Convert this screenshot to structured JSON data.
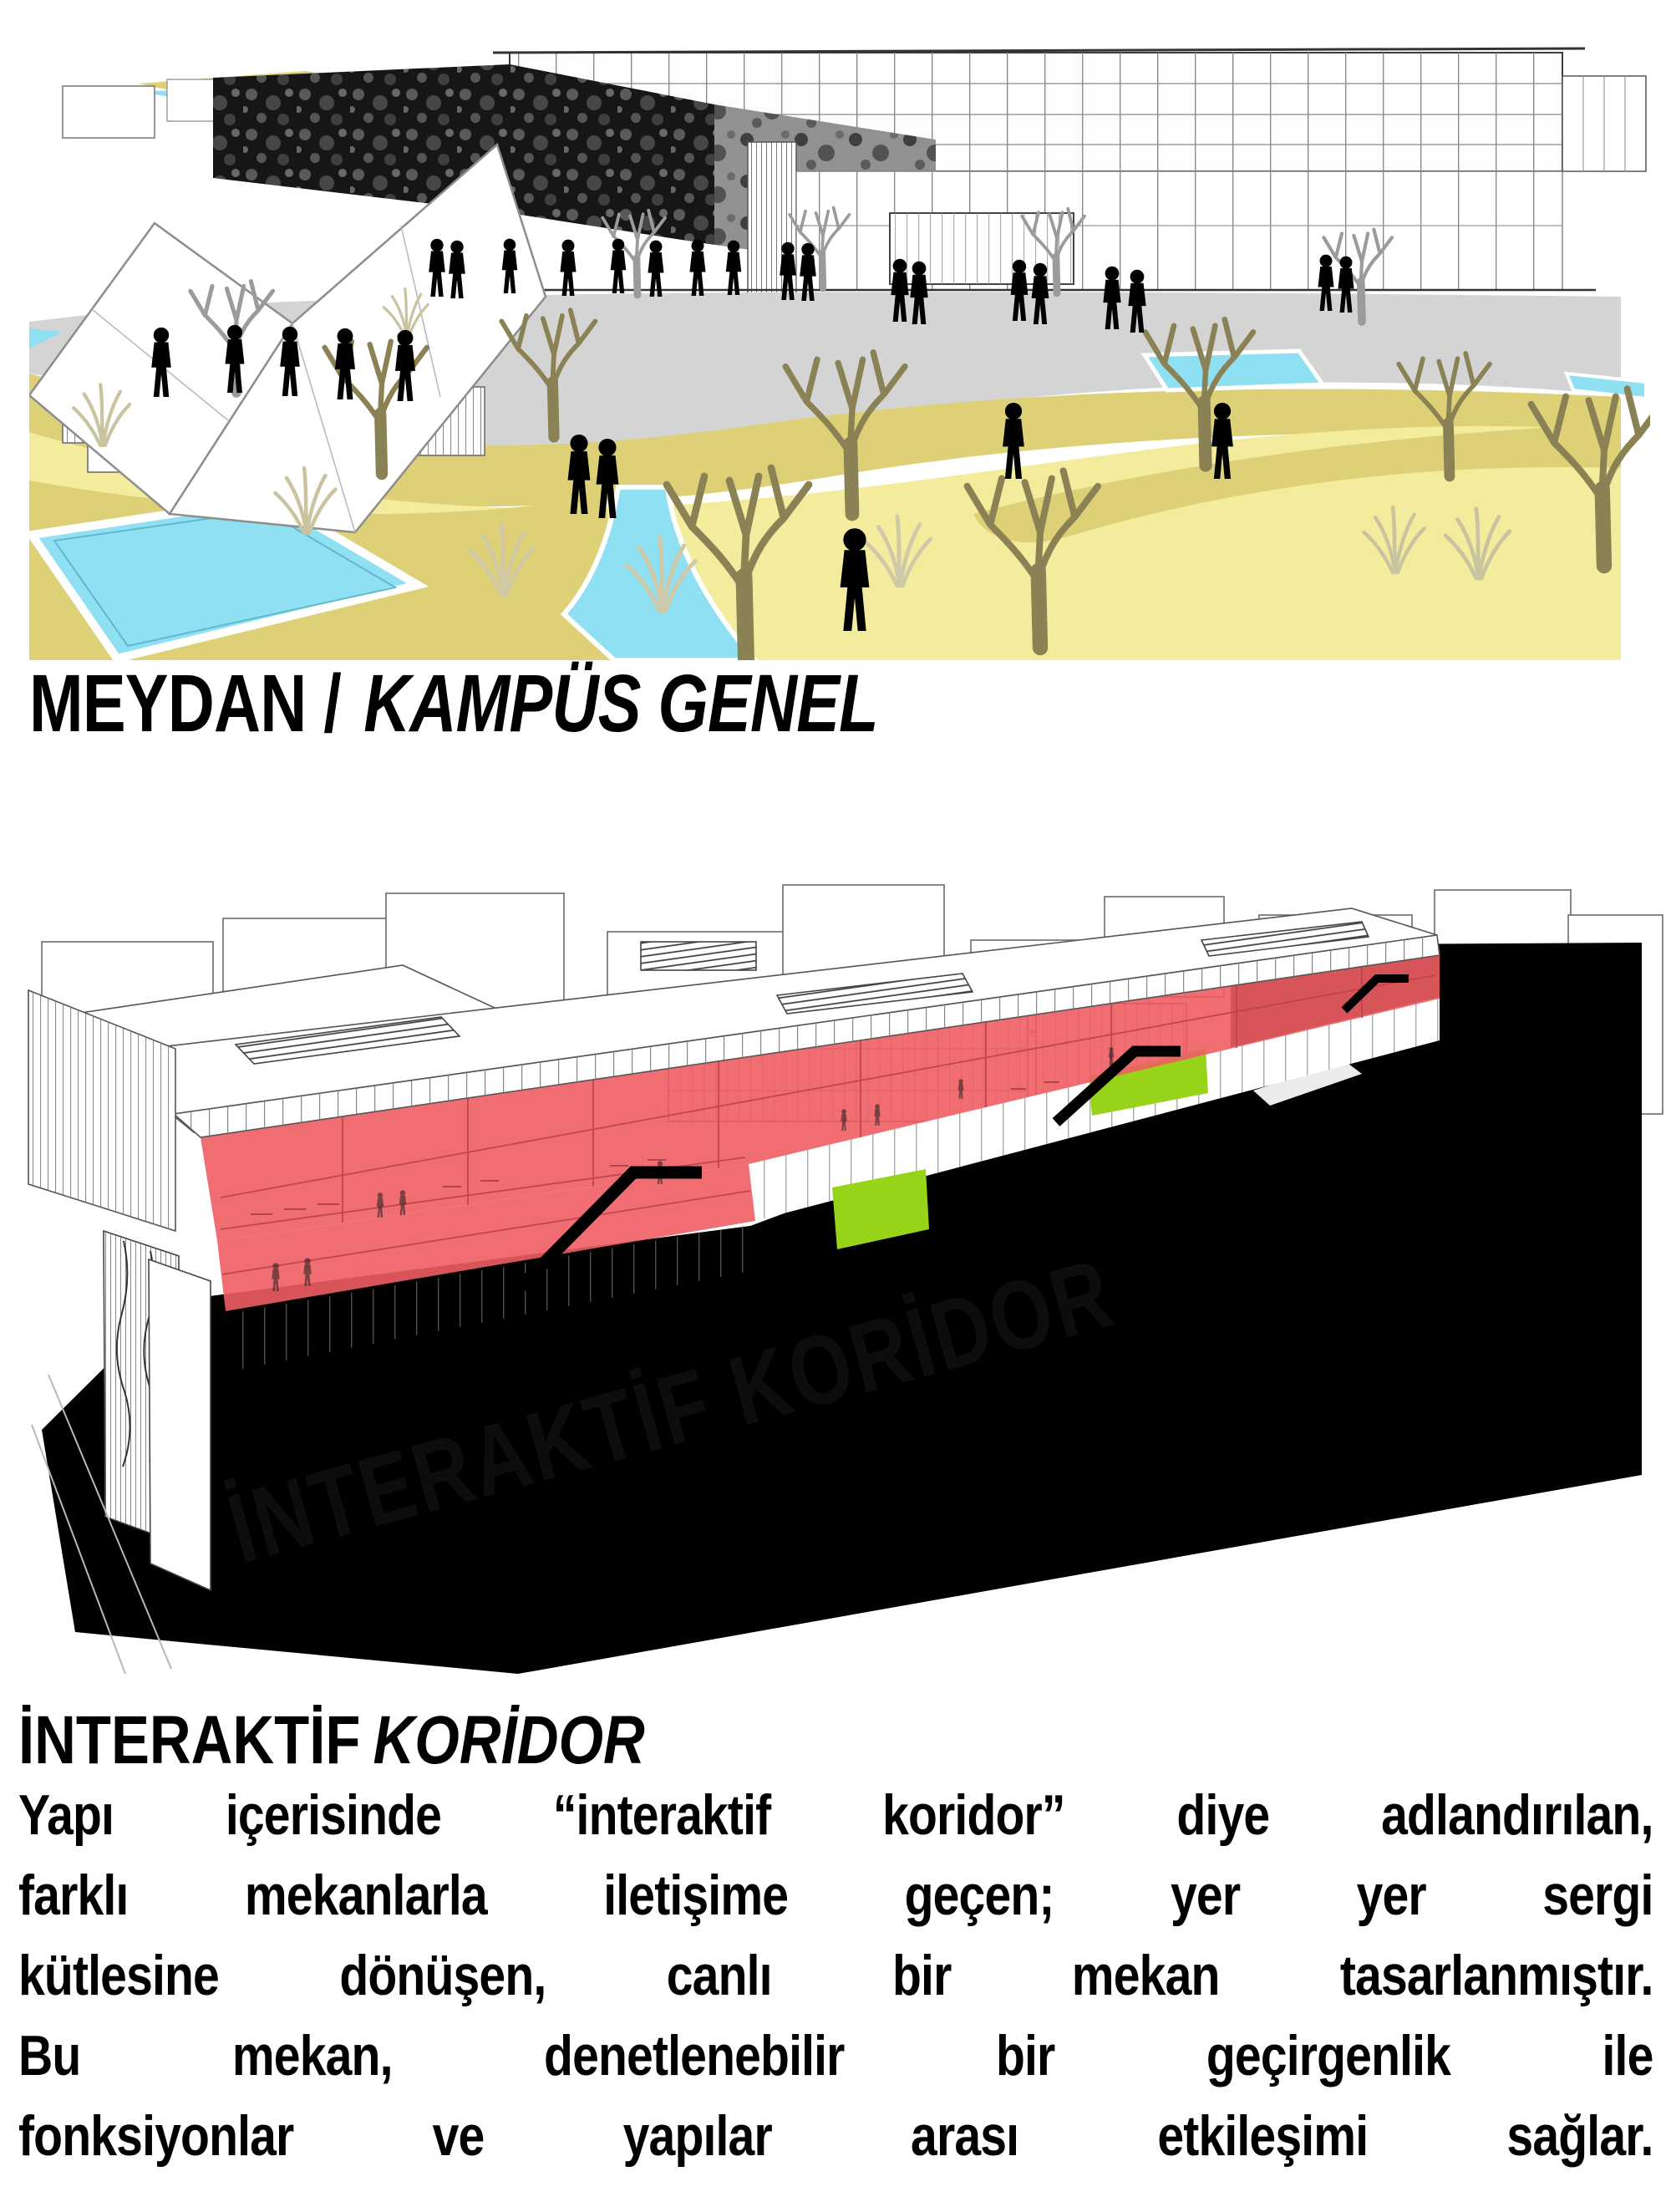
{
  "figures": {
    "campus": {
      "caption_bold": "MEYDAN /",
      "caption_italic": "KAMPÜS GENEL",
      "colors": {
        "lawn_light": "#f3ec9d",
        "lawn_dark": "#ddd077",
        "water": "#8ee0f2",
        "plaza_gray": "#d4d4d4",
        "facade_dark": "#161616",
        "tree_olive": "#8a8254",
        "tree_gray": "#9b9b9b",
        "silhouette": "#000000"
      }
    },
    "section": {
      "building_label": "İNTERAKTİF KORİDOR",
      "colors": {
        "corridor_red": "#ee5e63",
        "accent_green": "#97d319",
        "section_cut_black": "#000000",
        "wireframe_line": "#555555"
      }
    }
  },
  "text_block": {
    "heading_bold": "İNTERAKTİF",
    "heading_italic": "KORİDOR",
    "lines": [
      "Yapı içerisinde “interaktif koridor” diye adlandırılan,",
      "farklı mekanlarla iletişime geçen; yer yer sergi",
      "kütlesine dönüşen, canlı bir mekan tasarlanmıştır.",
      "Bu mekan, denetlenebilir bir geçirgenlik ile",
      "fonksiyonlar ve yapılar arası etkileşimi sağlar."
    ]
  }
}
